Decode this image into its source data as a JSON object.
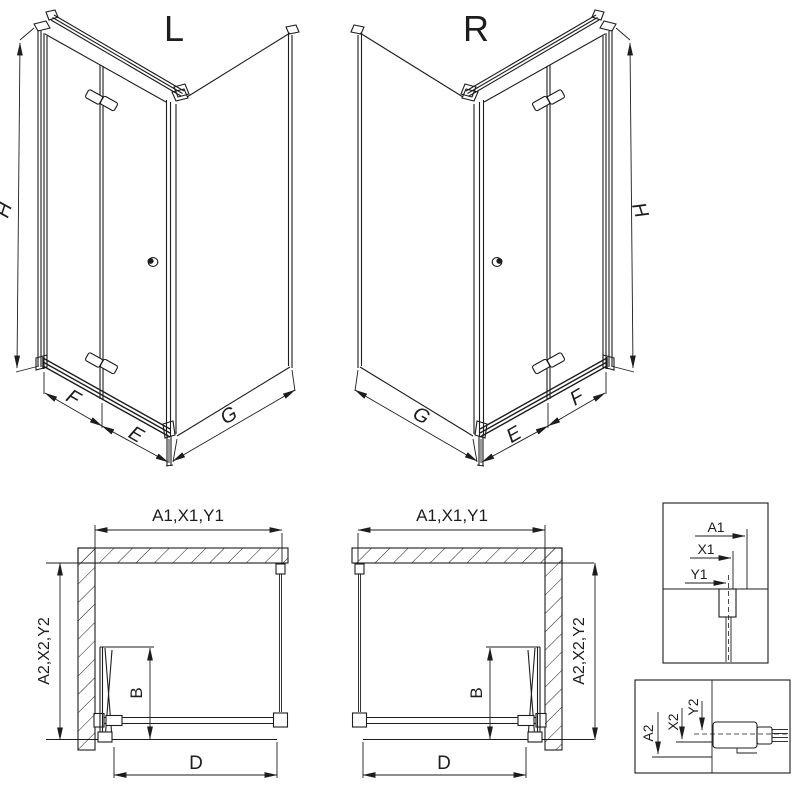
{
  "colors": {
    "ink": "#1d1d1d",
    "paper": "#ffffff"
  },
  "views": {
    "iso_left": {
      "title": "L",
      "height_label": "H",
      "door_panel_label": "F",
      "door_inner_label": "E",
      "side_panel_label": "G"
    },
    "iso_right": {
      "title": "R",
      "height_label": "H",
      "door_panel_label": "F",
      "door_inner_label": "E",
      "side_panel_label": "G"
    },
    "plan_left": {
      "width_label": "A1,X1,Y1",
      "depth_label": "A2,X2,Y2",
      "fold_depth_label": "B",
      "entry_label": "D"
    },
    "plan_right": {
      "width_label": "A1,X1,Y1",
      "depth_label": "A2,X2,Y2",
      "fold_depth_label": "B",
      "entry_label": "D"
    },
    "detail_width": {
      "a1": "A1",
      "x1": "X1",
      "y1": "Y1"
    },
    "detail_depth": {
      "a2": "A2",
      "x2": "X2",
      "y2": "Y2"
    }
  }
}
